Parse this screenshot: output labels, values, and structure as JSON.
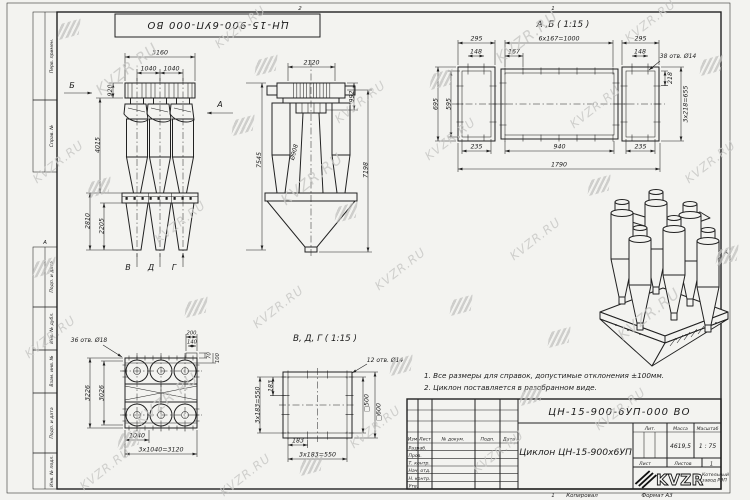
{
  "watermark": {
    "text": "KVZR.RU"
  },
  "frame": {
    "top_stamp": "ЦН-15-900-6УП-000 ВО",
    "zone2": "2",
    "zone1": "1",
    "zoneAl": "А",
    "zoneAr": "А",
    "margins": {
      "m1": "Перв. примен.",
      "m2": "Справ. №",
      "m3": "Подп. и дата",
      "m4": "Инв. № дубл.",
      "m5": "Взам. инв. №",
      "m6": "Подп. и дата",
      "m7": "Инв. № подл."
    },
    "footer": {
      "num": "1",
      "copied": "Копировал",
      "format": "Формат А3"
    }
  },
  "notes": {
    "n1": "1. Все размеры для справок, допустимые отклонения ±100мм.",
    "n2": "2. Циклон поставляется в разобранном виде."
  },
  "views": {
    "front": {
      "b": "Б",
      "a": "А",
      "v": "В",
      "d": "Д",
      "g": "Г",
      "d3160": "3160",
      "d1040a": "1040",
      "d1040b": "1040",
      "d920": "920",
      "d4015": "4015",
      "d2810": "2810",
      "d2205": "2205",
      "d7545": "7545"
    },
    "side": {
      "d2120": "2120",
      "d992": "992",
      "d908": "Ø908",
      "d7198": "7198"
    },
    "ab": {
      "title": "А ,Б ( 1:15 )",
      "d295l": "295",
      "d1000": "6х167=1000",
      "d295r": "295",
      "d148l": "148",
      "d167": "167",
      "d148r": "148",
      "holes": "38 отв. Ø14",
      "d218": "218",
      "d655": "3х218=655",
      "d695": "695",
      "d595": "595",
      "d235l": "235",
      "d940": "940",
      "d235r": "235",
      "d1790": "1790"
    },
    "plan": {
      "holes": "36 отв. Ø18",
      "d200": "200",
      "d140": "140",
      "d70": "70",
      "d100": "100",
      "d3226": "3226",
      "d3026": "3026",
      "d1040": "1040",
      "d3120": "3х1040=3120"
    },
    "vdg": {
      "title": "В, Д, Г ( 1:15 )",
      "holes": "12 отв. Ø14",
      "d183l": "183",
      "d550l": "3х183=550",
      "s500": "□500",
      "s600": "□600",
      "d183b": "183",
      "d550b": "3х183=550"
    }
  },
  "title_block": {
    "designation": "ЦН-15-900-6УП-000 ВО",
    "name": "Циклон ЦН-15-900х6УП",
    "cols": {
      "izm": "Изм",
      "list": "Лист",
      "doc": "№ докум.",
      "podp": "Подп.",
      "data": "Дата"
    },
    "rows": {
      "r1": "Разраб.",
      "r2": "Пров.",
      "r3": "Т. контр.",
      "r4": "Нач. отд.",
      "r5": "Н. контр.",
      "r6": "Утв."
    },
    "lit": "Лит.",
    "mass_label": "Масса",
    "scale_label": "Масштаб",
    "mass": "4619,5",
    "scale": "1 : 75",
    "sheet": "Лист",
    "sheets": "Листов",
    "sheets_val": "1",
    "logo": "KVZR",
    "logo_sub1": "Котельный",
    "logo_sub2": "завод РЭП"
  }
}
